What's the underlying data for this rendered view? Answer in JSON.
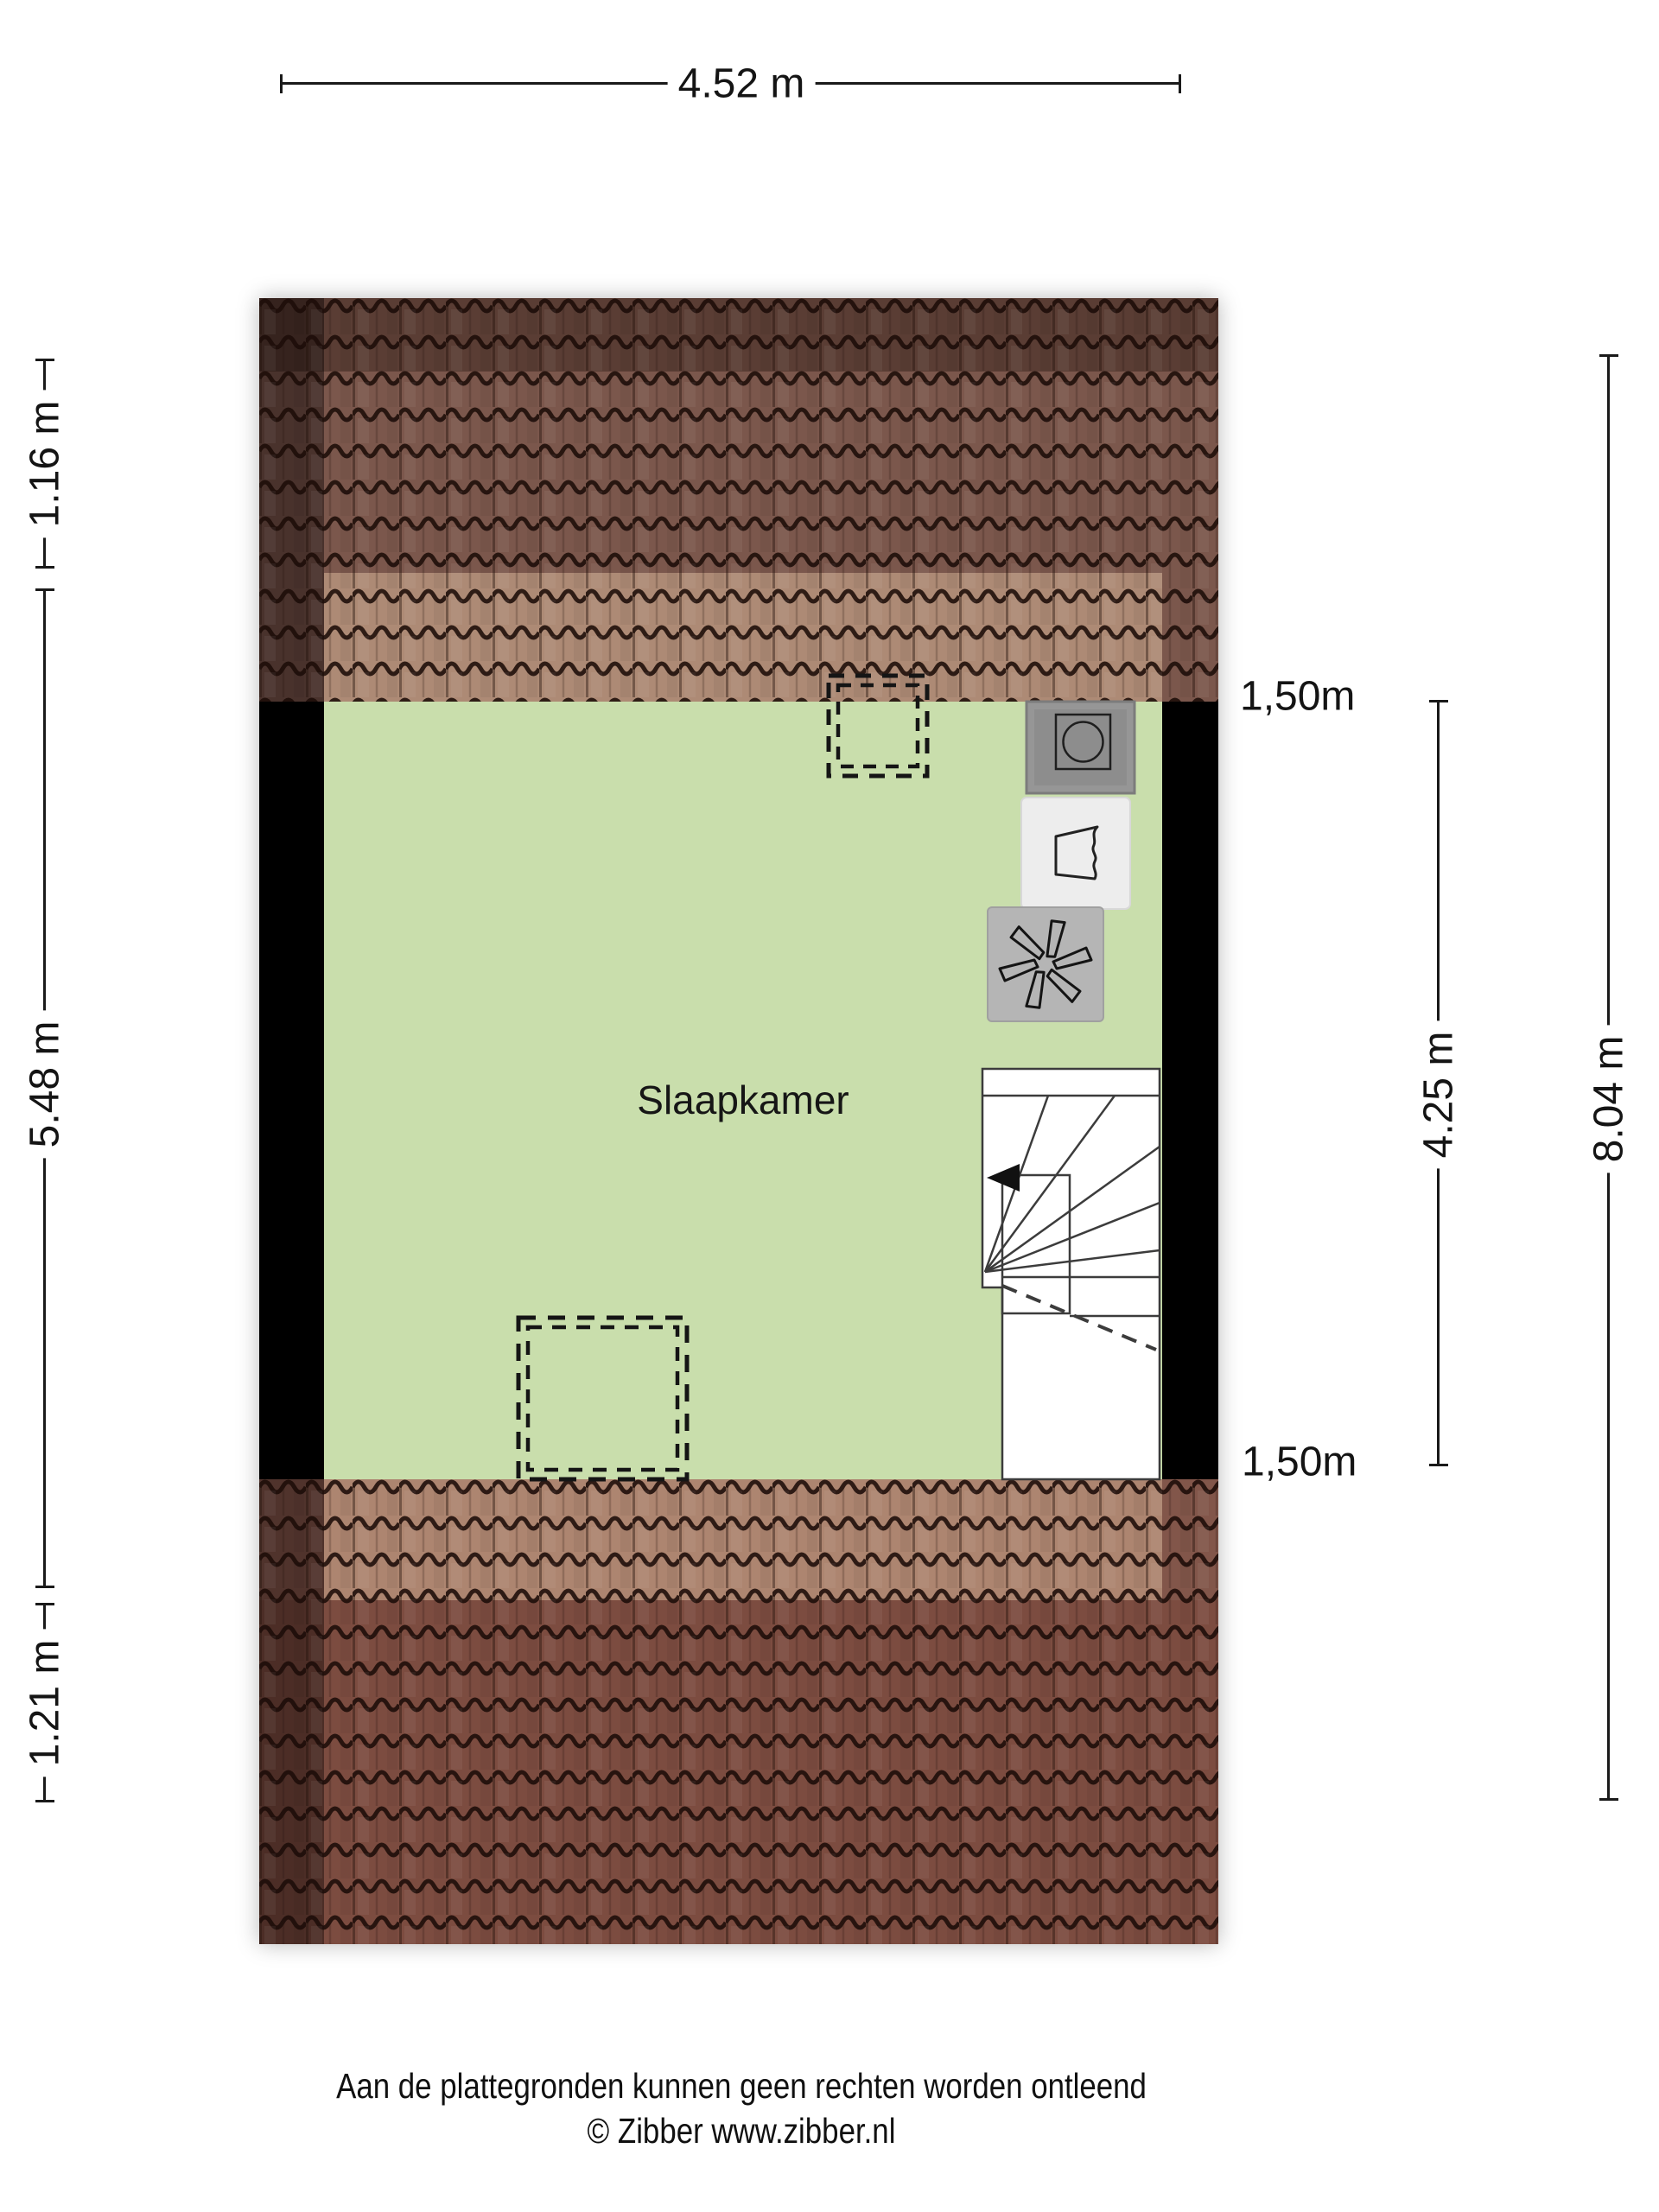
{
  "plan": {
    "room": {
      "label": "Slaapkamer"
    },
    "icons": [
      {
        "name": "washing-machine-connection",
        "glyph": "square-with-circle"
      },
      {
        "name": "boiler",
        "glyph": "pentagon-with-wavy-edge"
      },
      {
        "name": "mechanical-ventilation",
        "glyph": "fan-blades"
      }
    ],
    "stairs": {
      "direction_arrow": "left"
    },
    "colors": {
      "room_fill": "#c9deac",
      "roof_base_top": "#7b574c",
      "roof_base_bottom": "#82564a",
      "roof_dark_rows": "#5e4038",
      "roof_dormer_overlay": "#a87f6a",
      "wall": "#000000",
      "stairs_fill": "#ffffff",
      "icon_gray": "#969696",
      "icon_light": "#ededed",
      "icon_fan_gray": "#b5b5b5"
    }
  },
  "dimensions": {
    "top_width": {
      "label": "4.52 m"
    },
    "left": [
      {
        "label": "1.16 m"
      },
      {
        "label": "5.48 m"
      },
      {
        "label": "1.21 m"
      }
    ],
    "inner_height": {
      "label": "4.25 m"
    },
    "total_height": {
      "label": "8.04 m"
    },
    "knee_wall_top": {
      "label": "1,50m"
    },
    "knee_wall_bottom": {
      "label": "1,50m"
    }
  },
  "footer": {
    "disclaimer": "Aan de plattegronden kunnen geen rechten worden ontleend",
    "copyright": "© Zibber www.zibber.nl"
  }
}
